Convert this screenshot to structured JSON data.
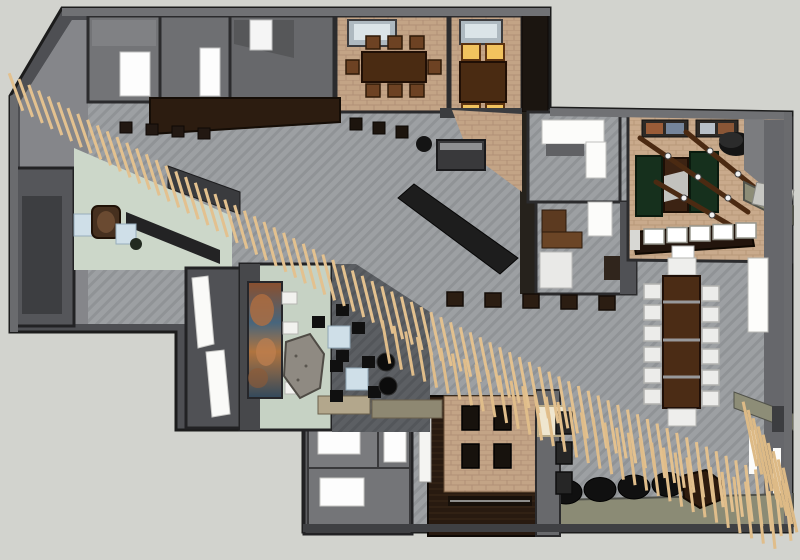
{
  "scene": {
    "description": "3D rendered top-down floor plan of a restaurant and lounge interior, SketchUp-style render, no visible text",
    "view": "top-down 3d render",
    "background": "#d2d3ce"
  },
  "palette": {
    "canvas": "#d2d3ce",
    "wall_dark": "#4e4f53",
    "wall_top": "#707174",
    "wall_outline": "#1c1c1c",
    "floor_tile_gray": "#9da0a3",
    "floor_tile_dark": "#5c5f63",
    "floor_brick_tan": "#c3a486",
    "floor_brick_game": "#c9aa8c",
    "floor_green_pale": "#ccd7c9",
    "wood_espresso": "#2c1c10",
    "wood_table": "#4a2b12",
    "slat_tan": "#e3c18f",
    "table_green": "#16301d",
    "seat_yellow": "#f2c35e",
    "seat_white": "#ececea",
    "table_blue": "#cfdfe8",
    "olive_bench": "#8d8d77",
    "furniture_black": "#111111",
    "door_white": "#fdfdfd"
  },
  "regions": [
    {
      "id": "wc-room-a",
      "name": "small room with white door (top left)"
    },
    {
      "id": "wc-room-b",
      "name": "small room with white door (top left)"
    },
    {
      "id": "storage-room",
      "name": "gray storage room"
    },
    {
      "id": "dining-room-1",
      "name": "private dining room with 6-seat wood table"
    },
    {
      "id": "dining-room-2",
      "name": "booth dining room with 4 yellow seats"
    },
    {
      "id": "corridor-bar",
      "name": "dark wood bar counter with stools"
    },
    {
      "id": "reception-green",
      "name": "pale green reception lounge with armchair and blue tables"
    },
    {
      "id": "mural-room",
      "name": "lounge wall with abstract mural, benches and rock feature"
    },
    {
      "id": "private-room-tables",
      "name": "narrow room with two long white tables"
    },
    {
      "id": "dark-lounge",
      "name": "dark tiled lounge with blue tables, black chairs, poufs"
    },
    {
      "id": "pantry-room",
      "name": "pantry / kitchen room with white counters"
    },
    {
      "id": "office-room",
      "name": "office with desk, white door and sofa"
    },
    {
      "id": "game-room",
      "name": "game room with green tables, beams with lights, wall art"
    },
    {
      "id": "game-bar",
      "name": "bar counter with five white stools"
    },
    {
      "id": "communal-table",
      "name": "long communal table with twelve white chairs"
    },
    {
      "id": "platform-dining",
      "name": "raised tan platform with four dark tables"
    },
    {
      "id": "rooms-bottom-left",
      "name": "gray service rooms with white skylights"
    },
    {
      "id": "slat-canopy",
      "name": "diagonal wooden slat canopy crossing the plan"
    },
    {
      "id": "stool-cylinders",
      "name": "row of dark cylinder stools"
    },
    {
      "id": "vestibule",
      "name": "entry vestibule"
    }
  ],
  "furniture_counts": {
    "slats_main_band": 80,
    "slats_second_row": 34,
    "slats_corner_fence": 9,
    "communal_chairs_per_side": 6,
    "game_bar_stools": 5,
    "platform_tables": 4,
    "cylinder_stools": 4,
    "yellow_booth_seats": 4,
    "dining1_chairs": 8,
    "mural_benches": 4
  },
  "generated": [
    {
      "kind": "rect-row",
      "parent": "#dining1-chairs",
      "name": "dining-chair",
      "x0": 366,
      "y0": 36,
      "dx": 22,
      "dy": 0,
      "count": 3,
      "w": 14,
      "h": 13,
      "fill": "#6d4223",
      "stroke": "#2f1a08",
      "sw": 1.5
    },
    {
      "kind": "rect-row",
      "parent": "#dining1-chairs",
      "name": "dining-chair",
      "x0": 366,
      "y0": 84,
      "dx": 22,
      "dy": 0,
      "count": 3,
      "w": 14,
      "h": 13,
      "fill": "#6d4223",
      "stroke": "#2f1a08",
      "sw": 1.5
    },
    {
      "kind": "rect-row",
      "parent": "#dining1-chairs",
      "name": "dining-chair",
      "x0": 346,
      "y0": 60,
      "dx": 0,
      "dy": 0,
      "count": 1,
      "w": 13,
      "h": 14,
      "fill": "#6d4223",
      "stroke": "#2f1a08",
      "sw": 1.5
    },
    {
      "kind": "rect-row",
      "parent": "#dining1-chairs",
      "name": "dining-chair",
      "x0": 428,
      "y0": 60,
      "dx": 0,
      "dy": 0,
      "count": 1,
      "w": 13,
      "h": 14,
      "fill": "#6d4223",
      "stroke": "#2f1a08",
      "sw": 1.5
    },
    {
      "kind": "rect-row",
      "parent": "#dining2-seats",
      "name": "yellow-booth-seat",
      "x0": 462,
      "y0": 44,
      "dx": 24,
      "dy": 0,
      "count": 2,
      "w": 18,
      "h": 16,
      "fill": "#f2c35e",
      "stroke": "#5c3311",
      "sw": 2
    },
    {
      "kind": "rect-row",
      "parent": "#dining2-seats",
      "name": "yellow-booth-seat",
      "x0": 462,
      "y0": 104,
      "dx": 24,
      "dy": 0,
      "count": 2,
      "w": 18,
      "h": 16,
      "fill": "#f2c35e",
      "stroke": "#5c3311",
      "sw": 2
    },
    {
      "kind": "rect-row",
      "parent": "#corridor-stools",
      "name": "bar-stool",
      "x0": 120,
      "y0": 122,
      "dx": 26,
      "dy": 2,
      "count": 4,
      "w": 12,
      "h": 11,
      "fill": "#221812",
      "stroke": "#0e0905",
      "sw": 1
    },
    {
      "kind": "rect-row",
      "parent": "#corridor-stools",
      "name": "side-table",
      "x0": 350,
      "y0": 118,
      "dx": 23,
      "dy": 4,
      "count": 3,
      "w": 12,
      "h": 12,
      "fill": "#1d150e",
      "stroke": "#0a0603",
      "sw": 1
    },
    {
      "kind": "rect-row",
      "parent": "#mid-stool-row",
      "name": "stool-table",
      "x0": 447,
      "y0": 292,
      "dx": 38,
      "dy": 1,
      "count": 5,
      "w": 16,
      "h": 14,
      "fill": "#2b1d12",
      "stroke": "#140d07",
      "sw": 1.5
    },
    {
      "kind": "rect-row",
      "parent": "#game-bar-stools",
      "name": "white-bar-stool",
      "x0": 644,
      "y0": 229,
      "dx": 23,
      "dy": -1.5,
      "count": 5,
      "w": 20,
      "h": 15,
      "fill": "#ffffff",
      "stroke": "#98988f",
      "sw": 1.5
    },
    {
      "kind": "rect-row",
      "parent": "#communal-chairs",
      "name": "communal-chair-left",
      "x0": 644,
      "y0": 284,
      "dx": 0,
      "dy": 21,
      "count": 6,
      "w": 17,
      "h": 15,
      "fill": "#ececea",
      "stroke": "#b2b2af",
      "sw": 1.5
    },
    {
      "kind": "rect-row",
      "parent": "#communal-chairs",
      "name": "communal-chair-right",
      "x0": 702,
      "y0": 286,
      "dx": 0,
      "dy": 21,
      "count": 6,
      "w": 17,
      "h": 15,
      "fill": "#ececea",
      "stroke": "#b2b2af",
      "sw": 1.5
    },
    {
      "kind": "rect-row",
      "parent": "#platform-tables",
      "name": "platform-table",
      "x0": 462,
      "y0": 406,
      "dx": 32,
      "dy": 0,
      "count": 2,
      "w": 17,
      "h": 24,
      "fill": "#17120d",
      "stroke": "#000000",
      "sw": 1.5
    },
    {
      "kind": "rect-row",
      "parent": "#platform-tables",
      "name": "platform-table",
      "x0": 462,
      "y0": 444,
      "dx": 32,
      "dy": 0,
      "count": 2,
      "w": 17,
      "h": 24,
      "fill": "#17120d",
      "stroke": "#000000",
      "sw": 1.5
    },
    {
      "kind": "rect-row",
      "parent": "#partition-tables",
      "name": "partition-side-table",
      "x0": 556,
      "y0": 412,
      "dx": 0,
      "dy": 30,
      "count": 3,
      "w": 16,
      "h": 22,
      "fill": "#262626",
      "stroke": "#0e0e0e",
      "sw": 1.5
    },
    {
      "kind": "rect-row",
      "parent": "#mural-benches",
      "name": "mural-bench",
      "x0": 282,
      "y0": 292,
      "dx": 1,
      "dy": 30,
      "count": 4,
      "w": 15,
      "h": 12,
      "fill": "#f2f2ef",
      "stroke": "#b5b5b2",
      "sw": 1
    },
    {
      "kind": "ellipse-row",
      "parent": "#cylinder-stools",
      "name": "cylinder-stool",
      "cx0": 566,
      "cy0": 492,
      "dx": 34,
      "dy": -2.5,
      "count": 4,
      "rx": 16,
      "ry": 12,
      "fill": "#101010",
      "stroke": "#000000",
      "sw": 1
    },
    {
      "kind": "ellipse-row",
      "parent": "#beam-lights",
      "name": "beam-light",
      "cx0": 668,
      "cy0": 156,
      "dx": 30,
      "dy": 21,
      "count": 3,
      "rx": 3,
      "ry": 3,
      "fill": "#f2f2f2",
      "stroke": "#444444",
      "sw": 1
    },
    {
      "kind": "ellipse-row",
      "parent": "#beam-lights",
      "name": "beam-light",
      "cx0": 710,
      "cy0": 151,
      "dx": 28,
      "dy": 23,
      "count": 2,
      "rx": 3,
      "ry": 3,
      "fill": "#f2f2f2",
      "stroke": "#444444",
      "sw": 1
    },
    {
      "kind": "ellipse-row",
      "parent": "#beam-lights",
      "name": "beam-light",
      "cx0": 684,
      "cy0": 198,
      "dx": 28,
      "dy": 17,
      "count": 2,
      "rx": 3,
      "ry": 3,
      "fill": "#f2f2f2",
      "stroke": "#444444",
      "sw": 1
    },
    {
      "kind": "slat-band",
      "parent": "#slat-layer",
      "name": "canopy-slat",
      "x1": 16,
      "y1": 92,
      "x2": 788,
      "y2": 512,
      "count": 80,
      "len1": 40,
      "len2": 58,
      "ang1": -20,
      "ang2": -6,
      "sag": 16,
      "color": "#e3c18f",
      "width": 3
    },
    {
      "kind": "slat-band",
      "parent": "#slat-layer",
      "name": "canopy-slat-row2",
      "x1": 386,
      "y1": 342,
      "x2": 772,
      "y2": 520,
      "count": 34,
      "len1": 44,
      "len2": 58,
      "ang1": -10,
      "ang2": -6,
      "sag": 4,
      "color": "#e0bd8a",
      "width": 3
    },
    {
      "kind": "slat-band",
      "parent": "#slat-layer",
      "name": "corner-fence-slat",
      "x1": 750,
      "y1": 434,
      "x2": 790,
      "y2": 500,
      "count": 9,
      "len1": 66,
      "len2": 66,
      "ang1": -12,
      "ang2": -12,
      "sag": 0,
      "color": "#ddba86",
      "width": 3
    }
  ]
}
